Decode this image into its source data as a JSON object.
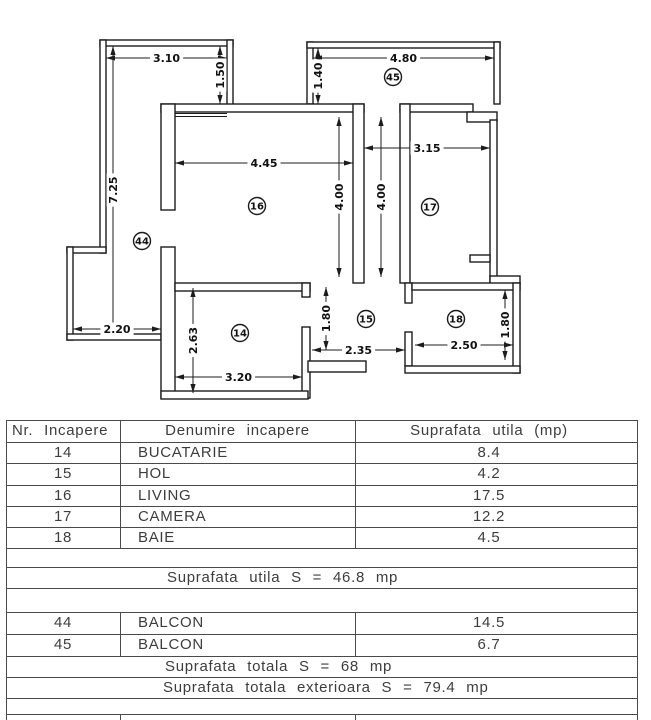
{
  "plan": {
    "rooms": [
      {
        "id": "16",
        "x": 257,
        "y": 206
      },
      {
        "id": "17",
        "x": 430,
        "y": 207
      },
      {
        "id": "44",
        "x": 142,
        "y": 241
      },
      {
        "id": "45",
        "x": 393,
        "y": 77
      },
      {
        "id": "14",
        "x": 240,
        "y": 333
      },
      {
        "id": "15",
        "x": 366,
        "y": 319
      },
      {
        "id": "18",
        "x": 456,
        "y": 319
      }
    ],
    "dimensions": [
      {
        "label": "3.10",
        "orient": "h",
        "x1": 106,
        "x2": 227,
        "y": 58
      },
      {
        "label": "1.50",
        "orient": "v",
        "x": 220,
        "y1": 46,
        "y2": 104
      },
      {
        "label": "7.25",
        "orient": "v",
        "x": 113,
        "y1": 46,
        "y2": 334
      },
      {
        "label": "2.20",
        "orient": "h",
        "x1": 73,
        "x2": 161,
        "y": 329
      },
      {
        "label": "4.80",
        "orient": "h",
        "x1": 313,
        "x2": 494,
        "y": 58
      },
      {
        "label": "1.40",
        "orient": "v",
        "x": 318,
        "y1": 48,
        "y2": 104
      },
      {
        "label": "4.45",
        "orient": "h",
        "x1": 175,
        "x2": 353,
        "y": 163
      },
      {
        "label": "4.00",
        "orient": "v",
        "x": 339,
        "y1": 117,
        "y2": 277
      },
      {
        "label": "4.00",
        "orient": "v",
        "x": 381,
        "y1": 117,
        "y2": 277
      },
      {
        "label": "3.15",
        "orient": "h",
        "x1": 364,
        "x2": 490,
        "y": 148
      },
      {
        "label": "2.63",
        "orient": "v",
        "x": 193,
        "y1": 288,
        "y2": 393
      },
      {
        "label": "3.20",
        "orient": "h",
        "x1": 175,
        "x2": 302,
        "y": 377
      },
      {
        "label": "1.80",
        "orient": "v",
        "x": 326,
        "y1": 287,
        "y2": 350
      },
      {
        "label": "2.35",
        "orient": "h",
        "x1": 312,
        "x2": 405,
        "y": 350
      },
      {
        "label": "2.50",
        "orient": "h",
        "x1": 415,
        "x2": 513,
        "y": 345
      },
      {
        "label": "1.80",
        "orient": "v",
        "x": 505,
        "y1": 290,
        "y2": 360
      }
    ],
    "walls": [
      [
        100,
        40,
        133,
        6
      ],
      [
        100,
        40,
        6,
        213
      ],
      [
        67,
        247,
        39,
        6
      ],
      [
        67,
        247,
        6,
        93
      ],
      [
        67,
        334,
        94,
        6
      ],
      [
        227,
        40,
        6,
        70
      ],
      [
        307,
        42,
        6,
        62
      ],
      [
        307,
        42,
        193,
        6
      ],
      [
        494,
        42,
        6,
        62
      ],
      [
        161,
        104,
        203,
        8
      ],
      [
        400,
        104,
        73,
        8
      ],
      [
        467,
        112,
        30,
        10
      ],
      [
        490,
        120,
        7,
        163
      ],
      [
        470,
        255,
        20,
        7
      ],
      [
        490,
        276,
        30,
        8
      ],
      [
        161,
        104,
        14,
        106
      ],
      [
        161,
        247,
        14,
        151
      ],
      [
        353,
        104,
        11,
        179
      ],
      [
        400,
        104,
        10,
        179
      ],
      [
        175,
        283,
        135,
        8
      ],
      [
        302,
        283,
        8,
        14
      ],
      [
        302,
        327,
        8,
        71
      ],
      [
        161,
        391,
        147,
        8
      ],
      [
        308,
        361,
        58,
        11
      ],
      [
        405,
        283,
        7,
        20
      ],
      [
        405,
        332,
        7,
        34
      ],
      [
        412,
        283,
        108,
        7
      ],
      [
        513,
        283,
        7,
        90
      ],
      [
        405,
        366,
        115,
        7
      ]
    ],
    "window_lines": [
      [
        175,
        113.5,
        227,
        113.5
      ],
      [
        175,
        116.5,
        227,
        116.5
      ]
    ]
  },
  "table": {
    "header": {
      "col1": "Nr. Incapere",
      "col2": "Denumire incapere",
      "col3": "Suprafata utila (mp)"
    },
    "rows": [
      {
        "nr": "14",
        "name": "BUCATARIE",
        "area": "8.4"
      },
      {
        "nr": "15",
        "name": "HOL",
        "area": "4.2"
      },
      {
        "nr": "16",
        "name": "LIVING",
        "area": "17.5"
      },
      {
        "nr": "17",
        "name": "CAMERA",
        "area": "12.2"
      },
      {
        "nr": "18",
        "name": "BAIE",
        "area": "4.5"
      }
    ],
    "summary_utila": "Suprafata utila S = 46.8 mp",
    "balcony_rows": [
      {
        "nr": "44",
        "name": "BALCON",
        "area": "14.5"
      },
      {
        "nr": "45",
        "name": "BALCON",
        "area": "6.7"
      }
    ],
    "summary_totala": "Suprafata totala S = 68 mp",
    "summary_exterioara": "Suprafata totala exterioara S = 79.4 mp"
  }
}
